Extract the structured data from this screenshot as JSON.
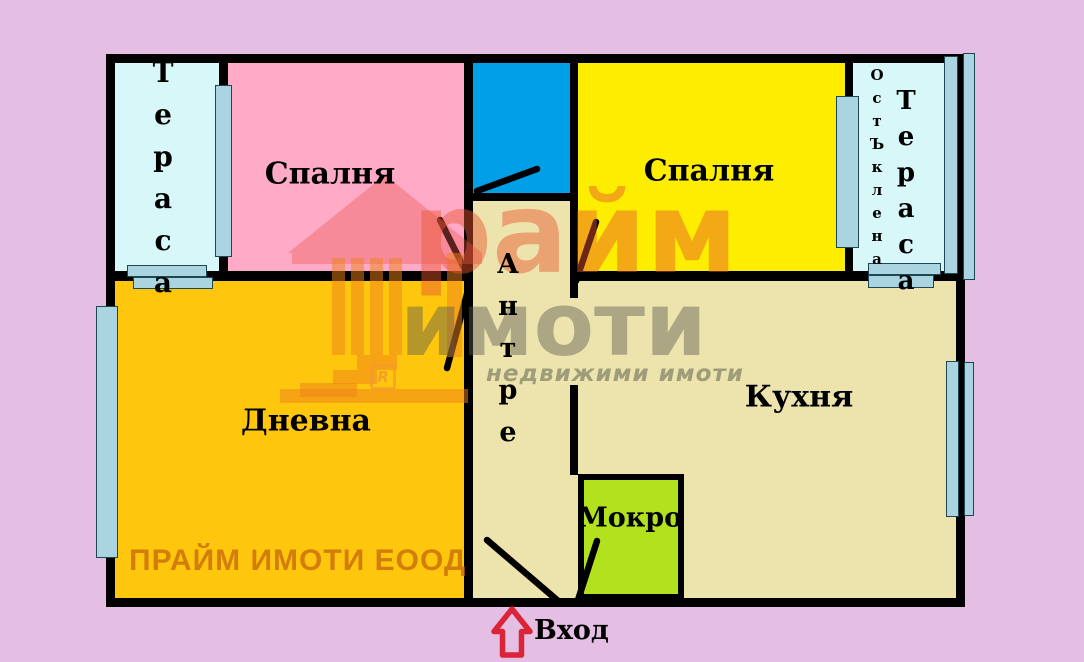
{
  "plan": {
    "rooms": {
      "terrace_left": "Тераса",
      "bedroom_1": "Спалня",
      "bedroom_2": "Спалня",
      "glazed_qualifier": "ОстЪклена",
      "terrace_right": "Тераса",
      "hallway": "Антре",
      "living_room": "Дневна",
      "kitchen": "Кухня",
      "wet_room": "Мокро"
    },
    "entrance_label": "Вход",
    "company_overlay": "ПРАЙМ ИМОТИ ЕООД",
    "watermark": {
      "brand_line1": "райм",
      "brand_line2": "имоти",
      "subtitle": "недвижими имоти",
      "registered_mark": "R"
    }
  },
  "colors": {
    "background": "#E5BEE3",
    "terrace": "#D8F7F8",
    "bedroom_pink": "#FFABC7",
    "bath_blue": "#009FE8",
    "bedroom_yellow": "#FDEE00",
    "living_orange": "#FEC70E",
    "hall_kitchen_tan": "#EDE3AD",
    "wet_green": "#B2E21D",
    "window": "#A9D4E0",
    "wall": "#000000",
    "arrow_red": "#DC2438",
    "company_text": "#CC720A"
  }
}
